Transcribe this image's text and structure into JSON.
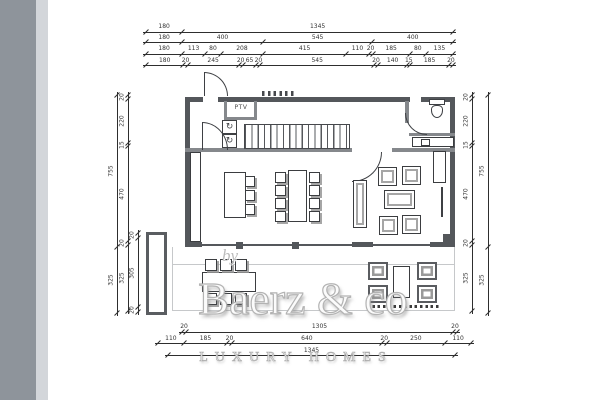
{
  "plan": {
    "ptv_label": "PTV"
  },
  "icons": {
    "washer_symbol": "↻",
    "dryer_symbol": "↻"
  },
  "watermark": {
    "by": "by",
    "brand": "Baerz & co",
    "tagline": "LUXURY HOMES"
  },
  "dimensions": {
    "top_rows": [
      [
        180,
        1345
      ],
      [
        180,
        400,
        545,
        400
      ],
      [
        180,
        113,
        80,
        208,
        415,
        110,
        20,
        185,
        80,
        135
      ],
      [
        180,
        20,
        245,
        20,
        65,
        20,
        545,
        20,
        140,
        15,
        185,
        20
      ]
    ],
    "left_outer": [
      755,
      325
    ],
    "left_middle": [
      20,
      220,
      15,
      470,
      20,
      325
    ],
    "left_inner": [
      20,
      305,
      20
    ],
    "right_inner": [
      20,
      220,
      15,
      470,
      20,
      325
    ],
    "right_outer": [
      755,
      325
    ],
    "bottom_rows": [
      [
        20,
        1305,
        20
      ],
      [
        110,
        185,
        20,
        640,
        20,
        250,
        110
      ],
      [
        1345
      ]
    ]
  }
}
